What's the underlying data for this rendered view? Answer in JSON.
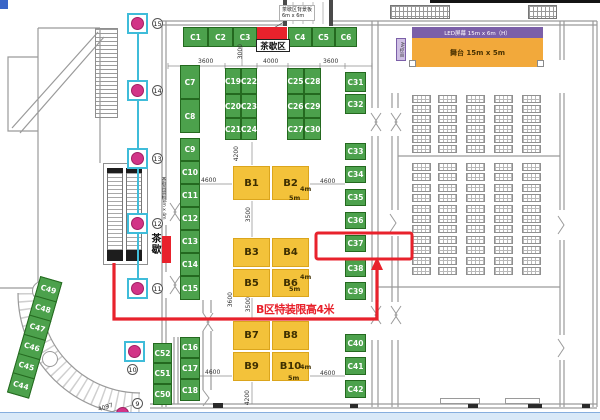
{
  "colors": {
    "green": "#4ca14c",
    "yellow": "#f3c23a",
    "red": "#e8222c",
    "cyan": "#3fbcd9",
    "magenta": "#d23487",
    "purple": "#7b5fa8",
    "orange": "#f2a93b"
  },
  "top": {
    "tea_area_label": "茶歇区",
    "callout_line1": "茶歇区背景板",
    "callout_line2": "6m x 6m"
  },
  "side": {
    "tea_label": "茶歇",
    "wall_note": "茶歇背景板4m x 4m"
  },
  "stage": {
    "led_label": "LED屏幕 15m x 6m（H）",
    "stage_label": "舞台 15m x 5m",
    "av_label": "AV控台"
  },
  "annotations": {
    "height_limit": "B区特装限高4米"
  },
  "booths": {
    "green": [
      {
        "id": "C1",
        "x": 183,
        "y": 27,
        "w": 25,
        "h": 20
      },
      {
        "id": "C2",
        "x": 208,
        "y": 27,
        "w": 25,
        "h": 20
      },
      {
        "id": "C3",
        "x": 233,
        "y": 27,
        "w": 24,
        "h": 20
      },
      {
        "id": "C4",
        "x": 288,
        "y": 27,
        "w": 24,
        "h": 20
      },
      {
        "id": "C5",
        "x": 312,
        "y": 27,
        "w": 23,
        "h": 20
      },
      {
        "id": "C6",
        "x": 335,
        "y": 27,
        "w": 22,
        "h": 20
      },
      {
        "id": "C7",
        "x": 180,
        "y": 65,
        "w": 20,
        "h": 34
      },
      {
        "id": "C8",
        "x": 180,
        "y": 99,
        "w": 20,
        "h": 34
      },
      {
        "id": "C9",
        "x": 180,
        "y": 138,
        "w": 20,
        "h": 23
      },
      {
        "id": "C10",
        "x": 180,
        "y": 161,
        "w": 20,
        "h": 23
      },
      {
        "id": "C11",
        "x": 180,
        "y": 184,
        "w": 20,
        "h": 23
      },
      {
        "id": "C12",
        "x": 180,
        "y": 207,
        "w": 20,
        "h": 23
      },
      {
        "id": "C13",
        "x": 180,
        "y": 230,
        "w": 20,
        "h": 23
      },
      {
        "id": "C14",
        "x": 180,
        "y": 253,
        "w": 20,
        "h": 23
      },
      {
        "id": "C15",
        "x": 180,
        "y": 276,
        "w": 20,
        "h": 24
      },
      {
        "id": "C16",
        "x": 180,
        "y": 337,
        "w": 20,
        "h": 21
      },
      {
        "id": "C17",
        "x": 180,
        "y": 358,
        "w": 20,
        "h": 21
      },
      {
        "id": "C18",
        "x": 180,
        "y": 379,
        "w": 20,
        "h": 22
      },
      {
        "id": "C52",
        "x": 153,
        "y": 343,
        "w": 19,
        "h": 20
      },
      {
        "id": "C51",
        "x": 153,
        "y": 363,
        "w": 19,
        "h": 21
      },
      {
        "id": "C50",
        "x": 153,
        "y": 384,
        "w": 19,
        "h": 21
      },
      {
        "id": "C19",
        "x": 225,
        "y": 68,
        "w": 16,
        "h": 26
      },
      {
        "id": "C22",
        "x": 241,
        "y": 68,
        "w": 16,
        "h": 26
      },
      {
        "id": "C20",
        "x": 225,
        "y": 94,
        "w": 16,
        "h": 24
      },
      {
        "id": "C23",
        "x": 241,
        "y": 94,
        "w": 16,
        "h": 24
      },
      {
        "id": "C21",
        "x": 225,
        "y": 118,
        "w": 16,
        "h": 22
      },
      {
        "id": "C24",
        "x": 241,
        "y": 118,
        "w": 16,
        "h": 22
      },
      {
        "id": "C25",
        "x": 287,
        "y": 68,
        "w": 17,
        "h": 26
      },
      {
        "id": "C28",
        "x": 304,
        "y": 68,
        "w": 17,
        "h": 26
      },
      {
        "id": "C26",
        "x": 287,
        "y": 94,
        "w": 17,
        "h": 24
      },
      {
        "id": "C29",
        "x": 304,
        "y": 94,
        "w": 17,
        "h": 24
      },
      {
        "id": "C27",
        "x": 287,
        "y": 118,
        "w": 17,
        "h": 22
      },
      {
        "id": "C30",
        "x": 304,
        "y": 118,
        "w": 17,
        "h": 22
      },
      {
        "id": "C31",
        "x": 345,
        "y": 72,
        "w": 21,
        "h": 20
      },
      {
        "id": "C32",
        "x": 345,
        "y": 94,
        "w": 21,
        "h": 20
      },
      {
        "id": "C33",
        "x": 345,
        "y": 143,
        "w": 21,
        "h": 17
      },
      {
        "id": "C34",
        "x": 345,
        "y": 166,
        "w": 21,
        "h": 17
      },
      {
        "id": "C35",
        "x": 345,
        "y": 189,
        "w": 21,
        "h": 17
      },
      {
        "id": "C36",
        "x": 345,
        "y": 212,
        "w": 21,
        "h": 17
      },
      {
        "id": "C37",
        "x": 345,
        "y": 235,
        "w": 21,
        "h": 17
      },
      {
        "id": "C38",
        "x": 345,
        "y": 259,
        "w": 21,
        "h": 18
      },
      {
        "id": "C39",
        "x": 345,
        "y": 282,
        "w": 21,
        "h": 18
      },
      {
        "id": "C40",
        "x": 345,
        "y": 334,
        "w": 21,
        "h": 18
      },
      {
        "id": "C41",
        "x": 345,
        "y": 357,
        "w": 21,
        "h": 18
      },
      {
        "id": "C42",
        "x": 345,
        "y": 380,
        "w": 21,
        "h": 18
      }
    ],
    "diagonal": [
      "C49",
      "C48",
      "C47",
      "C46",
      "C45",
      "C44"
    ],
    "yellow": [
      {
        "id": "B1",
        "x": 232,
        "y": 165,
        "w": 39,
        "h": 36
      },
      {
        "id": "B2",
        "x": 271,
        "y": 165,
        "w": 39,
        "h": 36
      },
      {
        "id": "B3",
        "x": 232,
        "y": 237,
        "w": 39,
        "h": 31
      },
      {
        "id": "B4",
        "x": 271,
        "y": 237,
        "w": 39,
        "h": 31
      },
      {
        "id": "B5",
        "x": 232,
        "y": 268,
        "w": 39,
        "h": 30
      },
      {
        "id": "B6",
        "x": 271,
        "y": 268,
        "w": 39,
        "h": 30
      },
      {
        "id": "B7",
        "x": 232,
        "y": 320,
        "w": 39,
        "h": 31
      },
      {
        "id": "B8",
        "x": 271,
        "y": 320,
        "w": 39,
        "h": 31
      },
      {
        "id": "B9",
        "x": 232,
        "y": 351,
        "w": 39,
        "h": 31
      },
      {
        "id": "B10",
        "x": 271,
        "y": 351,
        "w": 39,
        "h": 31
      }
    ]
  },
  "size_notes": [
    {
      "t": "4m",
      "x": 300,
      "y": 185
    },
    {
      "t": "5m",
      "x": 289,
      "y": 194
    },
    {
      "t": "4m",
      "x": 300,
      "y": 273
    },
    {
      "t": "5m",
      "x": 289,
      "y": 285
    },
    {
      "t": "4m",
      "x": 300,
      "y": 363
    },
    {
      "t": "5m",
      "x": 288,
      "y": 374
    }
  ],
  "dimensions": [
    {
      "t": "3600",
      "x": 198,
      "y": 58
    },
    {
      "t": "3000",
      "x": 237,
      "y": 44,
      "v": 1
    },
    {
      "t": "4000",
      "x": 263,
      "y": 58
    },
    {
      "t": "3600",
      "x": 323,
      "y": 58
    },
    {
      "t": "4200",
      "x": 233,
      "y": 146,
      "v": 1
    },
    {
      "t": "4600",
      "x": 201,
      "y": 177
    },
    {
      "t": "4600",
      "x": 320,
      "y": 178
    },
    {
      "t": "3500",
      "x": 245,
      "y": 207,
      "v": 1
    },
    {
      "t": "3600",
      "x": 227,
      "y": 292,
      "v": 1
    },
    {
      "t": "3500",
      "x": 245,
      "y": 297,
      "v": 1
    },
    {
      "t": "4600",
      "x": 205,
      "y": 369
    },
    {
      "t": "4600",
      "x": 320,
      "y": 370
    },
    {
      "t": "4200",
      "x": 244,
      "y": 390,
      "v": 1
    },
    {
      "t": "4097",
      "x": 98,
      "y": 404,
      "r": -18
    }
  ],
  "markers": {
    "boxed": [
      {
        "n": "15",
        "x": 127,
        "y": 13
      },
      {
        "n": "14",
        "x": 127,
        "y": 80
      },
      {
        "n": "13",
        "x": 127,
        "y": 148
      },
      {
        "n": "12",
        "x": 127,
        "y": 213
      },
      {
        "n": "11",
        "x": 127,
        "y": 278
      },
      {
        "n": "10",
        "x": 124,
        "y": 341,
        "below": 1
      }
    ],
    "loose": {
      "n": "9",
      "lx": 132,
      "ly": 398,
      "dx": 116,
      "dy": 407
    }
  },
  "seating": {
    "cols": [
      412,
      438,
      466,
      494,
      522
    ],
    "w": 19,
    "h": 8,
    "banks": [
      {
        "y": 95,
        "rows": 6,
        "pitch": 10
      },
      {
        "y": 163,
        "rows": 11,
        "pitch": 10.4
      }
    ]
  }
}
